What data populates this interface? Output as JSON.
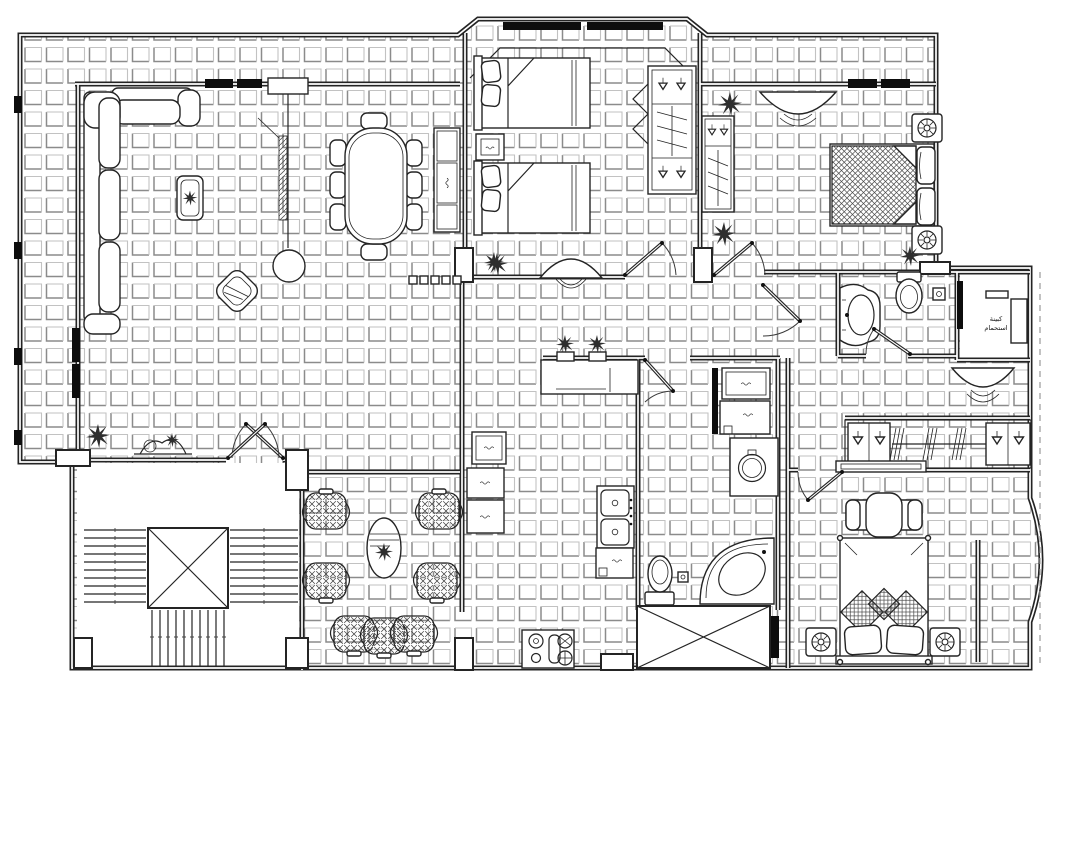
{
  "plan": {
    "labels": {
      "shower_room_line1": "كبينة",
      "shower_room_line2": "استحمام"
    },
    "colors": {
      "ink": "#242424",
      "tile_shadow": "#8b8b8b",
      "tile_light": "#c2c2c2",
      "window_fill": "#0d0d0d",
      "paper": "#ffffff"
    }
  }
}
